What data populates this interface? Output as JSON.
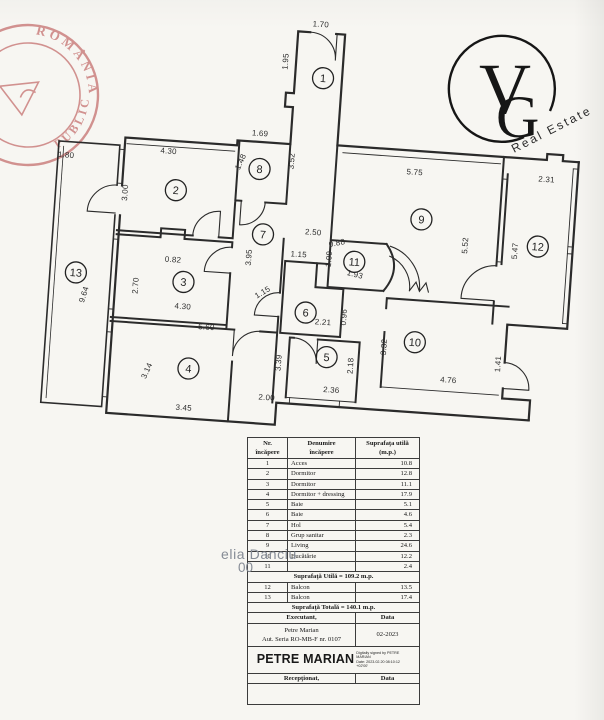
{
  "branding": {
    "logo_letter_v": "V",
    "logo_letter_g": "G",
    "logo_subtitle": "Real Estate"
  },
  "stamp": {
    "arc_text_top": "ROMÂNIA",
    "arc_text_bottom": "PUBLIC"
  },
  "plan": {
    "rooms": [
      {
        "n": "1",
        "x": 311,
        "y": 77
      },
      {
        "n": "2",
        "x": 172,
        "y": 199
      },
      {
        "n": "3",
        "x": 186,
        "y": 290
      },
      {
        "n": "4",
        "x": 197,
        "y": 376
      },
      {
        "n": "5",
        "x": 334,
        "y": 355
      },
      {
        "n": "6",
        "x": 310,
        "y": 312
      },
      {
        "n": "7",
        "x": 262,
        "y": 237
      },
      {
        "n": "8",
        "x": 254,
        "y": 172
      },
      {
        "n": "9",
        "x": 419,
        "y": 211
      },
      {
        "n": "10",
        "x": 421,
        "y": 334
      },
      {
        "n": "11",
        "x": 355,
        "y": 258
      },
      {
        "n": "12",
        "x": 537,
        "y": 230
      },
      {
        "n": "13",
        "x": 78,
        "y": 288
      }
    ],
    "dims": [
      {
        "t": "1.95",
        "x": 275,
        "y": 63,
        "r": -90
      },
      {
        "t": "1.70",
        "x": 305,
        "y": 26,
        "r": 0
      },
      {
        "t": "3.52",
        "x": 288,
        "y": 162,
        "r": -90
      },
      {
        "t": "1.69",
        "x": 252,
        "y": 139,
        "r": 0
      },
      {
        "t": "1.48",
        "x": 237,
        "y": 167,
        "r": -70
      },
      {
        "t": "4.30",
        "x": 162,
        "y": 163,
        "r": 0
      },
      {
        "t": "3.00",
        "x": 124,
        "y": 205,
        "r": -90
      },
      {
        "t": "1.80",
        "x": 60,
        "y": 174,
        "r": 0
      },
      {
        "t": "9.64",
        "x": 90,
        "y": 310,
        "r": -77
      },
      {
        "t": "2.70",
        "x": 141,
        "y": 297,
        "r": -90
      },
      {
        "t": "0.82",
        "x": 174,
        "y": 271,
        "r": 0
      },
      {
        "t": "4.30",
        "x": 187,
        "y": 317,
        "r": 0
      },
      {
        "t": "5.60",
        "x": 212,
        "y": 336,
        "r": 0
      },
      {
        "t": "3.14",
        "x": 158,
        "y": 382,
        "r": -70
      },
      {
        "t": "3.45",
        "x": 195,
        "y": 418,
        "r": 0
      },
      {
        "t": "2.00",
        "x": 277,
        "y": 402,
        "r": 0
      },
      {
        "t": "3.39",
        "x": 289,
        "y": 364,
        "r": -90
      },
      {
        "t": "3.95",
        "x": 252,
        "y": 261,
        "r": -90
      },
      {
        "t": "2.36",
        "x": 341,
        "y": 390,
        "r": 0
      },
      {
        "t": "2.18",
        "x": 361,
        "y": 362,
        "r": -90
      },
      {
        "t": "2.21",
        "x": 328,
        "y": 323,
        "r": 0
      },
      {
        "t": "0.96",
        "x": 351,
        "y": 314,
        "r": -90
      },
      {
        "t": "1.15",
        "x": 299,
        "y": 257,
        "r": 0
      },
      {
        "t": "1.15",
        "x": 267,
        "y": 297,
        "r": -35
      },
      {
        "t": "2.50",
        "x": 312,
        "y": 234,
        "r": 0
      },
      {
        "t": "0.88",
        "x": 337,
        "y": 243,
        "r": -15
      },
      {
        "t": "1.09",
        "x": 332,
        "y": 257,
        "r": -90
      },
      {
        "t": "1.93",
        "x": 356,
        "y": 273,
        "r": 10
      },
      {
        "t": "5.75",
        "x": 409,
        "y": 167,
        "r": 0
      },
      {
        "t": "5.52",
        "x": 467,
        "y": 234,
        "r": -90
      },
      {
        "t": "2.31",
        "x": 541,
        "y": 165,
        "r": 0
      },
      {
        "t": "5.47",
        "x": 517,
        "y": 236,
        "r": -90
      },
      {
        "t": "3.32",
        "x": 393,
        "y": 341,
        "r": -90
      },
      {
        "t": "4.76",
        "x": 457,
        "y": 372,
        "r": 0
      },
      {
        "t": "1.41",
        "x": 508,
        "y": 350,
        "r": -90
      }
    ]
  },
  "table": {
    "headers": [
      [
        "Nr.",
        "încăpere"
      ],
      [
        "Denumire",
        "încăpere"
      ],
      [
        "Suprafaţa utilă",
        "(m.p.)"
      ]
    ],
    "rows": [
      [
        "1",
        "Acces",
        "10.8"
      ],
      [
        "2",
        "Dormitor",
        "12.8"
      ],
      [
        "3",
        "Dormitor",
        "11.1"
      ],
      [
        "4",
        "Dormitor + dressing",
        "17.9"
      ],
      [
        "5",
        "Baie",
        "5.1"
      ],
      [
        "6",
        "Baie",
        "4.6"
      ],
      [
        "7",
        "Hol",
        "5.4"
      ],
      [
        "8",
        "Grup sanitar",
        "2.3"
      ],
      [
        "9",
        "Living",
        "24.6"
      ],
      [
        "10",
        "Bucătărie",
        "12.2"
      ],
      [
        "11",
        "",
        "2.4"
      ]
    ],
    "subtotal": "Suprafaţă Utilă = 109.2 m.p.",
    "rows2": [
      [
        "12",
        "Balcon",
        "13.5"
      ],
      [
        "13",
        "Balcon",
        "17.4"
      ]
    ],
    "total": "Suprafaţă Totală = 140.1 m.p.",
    "executant_label": "Executant,",
    "data_label": "Data",
    "executant_name": "Petre Marian",
    "executant_aut": "Aut. Seria RO-MB-F nr. 0107",
    "executant_date": "02-2023",
    "signature_name": "PETRE MARIAN",
    "signature_note_1": "Digitally signed by PETRE MARIAN",
    "signature_note_2": "Date: 2023.02.20 08:10:12 +02'00'",
    "receptionat_label": "Recepţionat,",
    "data_label2": "Data"
  },
  "watermark": {
    "line1": "elia Danciu",
    "line2": "00"
  },
  "colors": {
    "wall": "#2b2b2b",
    "stamp_red": "#b34040",
    "logo_ink": "#161616",
    "watermark_gray": "#868c96"
  }
}
